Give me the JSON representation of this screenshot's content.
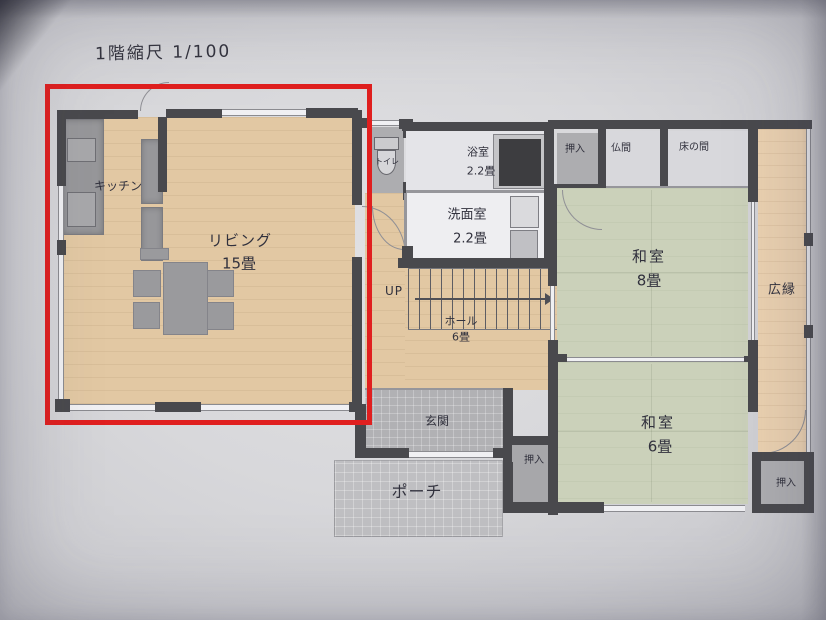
{
  "title": "1階縮尺 1/100",
  "highlight": {
    "color": "#e01f1f"
  },
  "rooms": {
    "kitchen": {
      "label": "キッチン"
    },
    "living": {
      "label": "リビング",
      "size": "15畳"
    },
    "toilet": {
      "label": "トイレ"
    },
    "bath": {
      "label": "浴室",
      "size": "2.2畳"
    },
    "washroom": {
      "label": "洗面室",
      "size": "2.2畳"
    },
    "closet_top": {
      "label": "押入"
    },
    "butsuma": {
      "label": "仏間"
    },
    "tokonoma": {
      "label": "床の間"
    },
    "washitsu_8": {
      "label": "和室",
      "size": "8畳"
    },
    "hiroen": {
      "label": "広縁"
    },
    "stairs": {
      "label": "UP"
    },
    "hall": {
      "label": "ホール",
      "size": "6畳"
    },
    "genkan": {
      "label": "玄関"
    },
    "closet_mid": {
      "label": "押入"
    },
    "washitsu_6": {
      "label": "和室",
      "size": "6畳"
    },
    "closet_br": {
      "label": "押入"
    },
    "porch": {
      "label": "ポーチ"
    }
  }
}
